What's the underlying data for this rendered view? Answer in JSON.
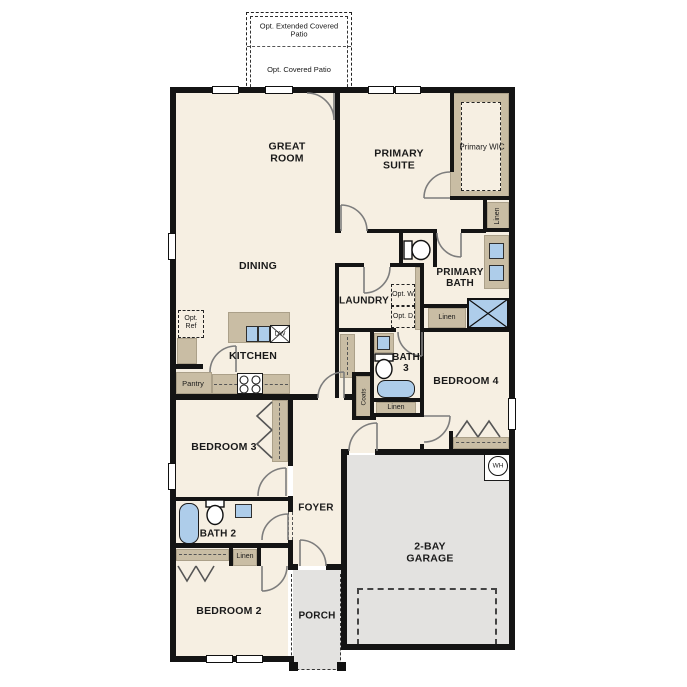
{
  "plan": {
    "labels": {
      "opt_extended_patio": "Opt. Extended Covered Patio",
      "opt_covered_patio": "Opt. Covered Patio",
      "great_room": "GREAT ROOM",
      "dining": "DINING",
      "primary_suite": "PRIMARY SUITE",
      "primary_wic": "Primary WIC",
      "linen": "Linen",
      "primary_bath": "PRIMARY BATH",
      "laundry": "LAUNDRY",
      "opt_washer": "Opt. W",
      "opt_dryer": "Opt. D",
      "kitchen": "KITCHEN",
      "opt_ref": "Opt. Ref",
      "dishwasher": "DW",
      "pantry": "Pantry",
      "bath_3": "BATH 3",
      "bedroom_4": "BEDROOM 4",
      "coats": "Coats",
      "bedroom_3": "BEDROOM 3",
      "foyer": "FOYER",
      "bath_2": "BATH 2",
      "bedroom_2": "BEDROOM 2",
      "porch": "PORCH",
      "garage": "2-BAY GARAGE",
      "water_heater": "WH"
    },
    "colors": {
      "floor": "#f6efe2",
      "cabinet": "#c9bda4",
      "optional": "#e3e2e0",
      "fixture": "#aecdea",
      "wall": "#141414"
    }
  }
}
